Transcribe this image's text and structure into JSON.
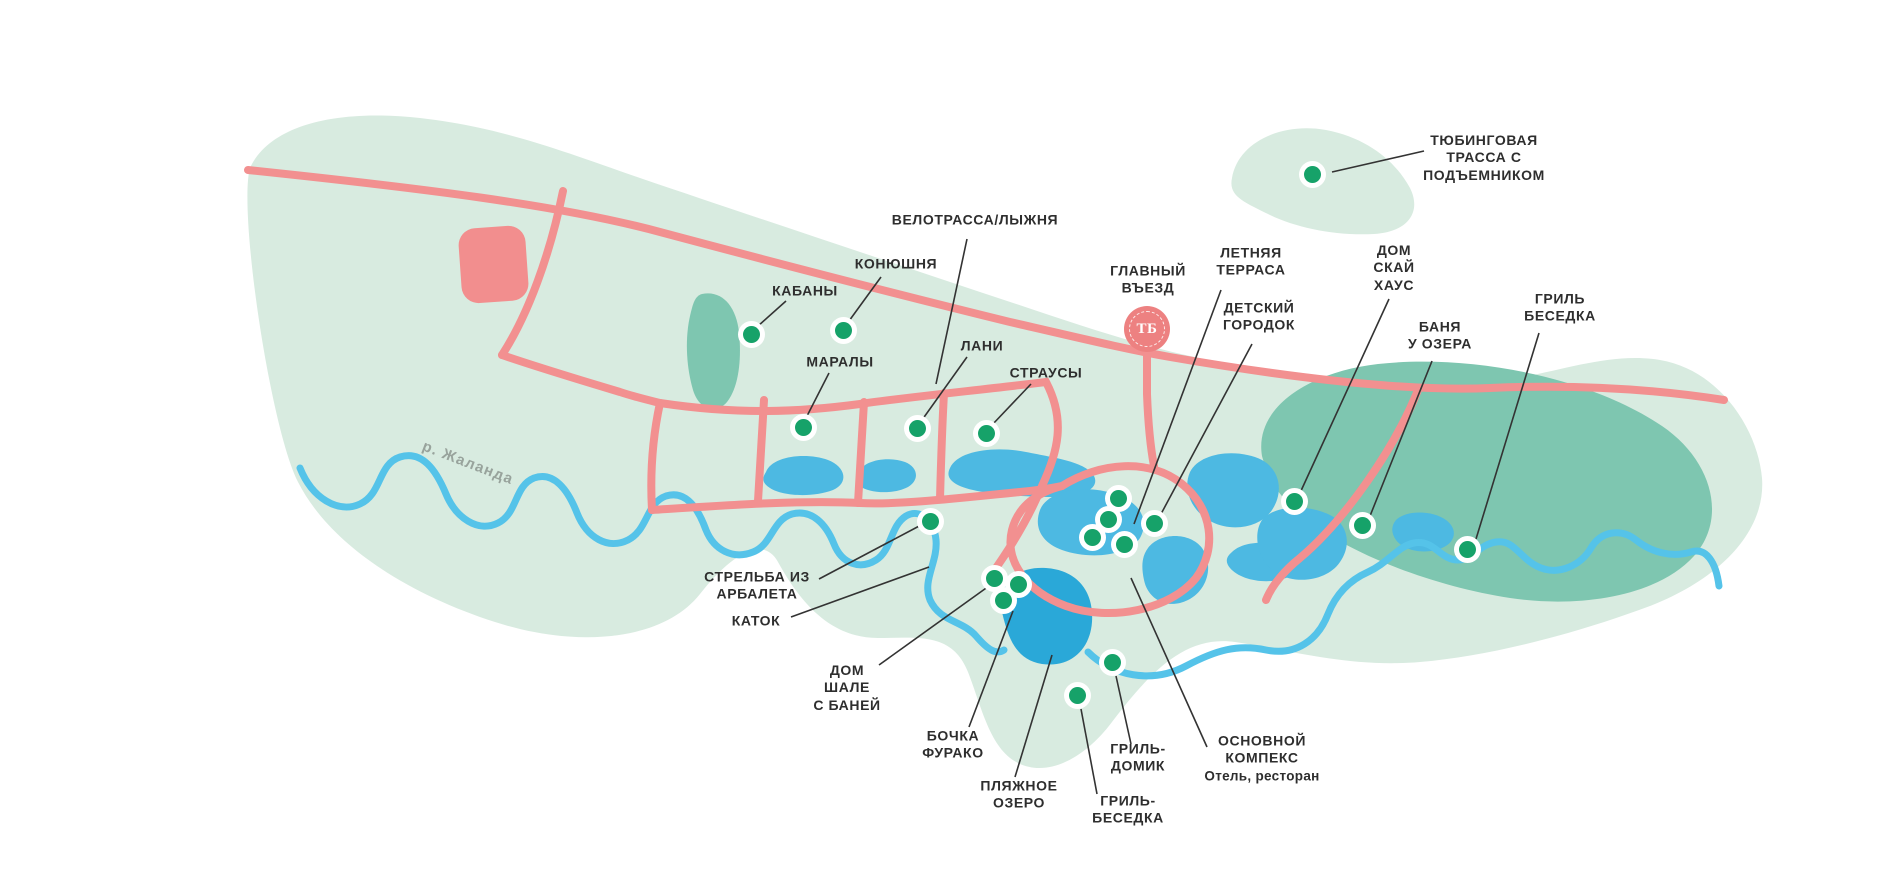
{
  "map": {
    "river_label": "р. Жаланда",
    "entrance": {
      "label": "ГЛАВНЫЙ\nВЪЕЗД",
      "monogram": "ТБ"
    },
    "pois": {
      "tubing": "ТЮБИНГОВАЯ\nТРАССА С\nПОДЪЕМНИКОМ",
      "bike_ski": "ВЕЛОТРАССА/ЛЫЖНЯ",
      "stables": "КОНЮШНЯ",
      "boars": "КАБАНЫ",
      "deer": "МАРАЛЫ",
      "fallow_deer": "ЛАНИ",
      "ostriches": "СТРАУСЫ",
      "summer_terrace": "ЛЕТНЯЯ\nТЕРРАСА",
      "kids_playground": "ДЕТСКИЙ\nГОРОДОК",
      "sky_house": "ДОМ\nСКАЙ\nХАУС",
      "lake_banya": "БАНЯ\nУ ОЗЕРА",
      "grill_gazebo_east": "ГРИЛЬ\nБЕСЕДКА",
      "crossbow": "СТРЕЛЬБА ИЗ\nАРБАЛЕТА",
      "ice_rink": "КАТОК",
      "chalet": "ДОМ\nШАЛЕ\nС БАНЕЙ",
      "furaco": "БОЧКА\nФУРАКО",
      "beach_lake": "ПЛЯЖНОЕ\nОЗЕРО",
      "grill_house": "ГРИЛЬ-\nДОМИК",
      "grill_gazebo_south": "ГРИЛЬ-\nБЕСЕДКА",
      "main_complex_title": "ОСНОВНОЙ\nКОМПЕКС",
      "main_complex_subtitle": "Отель, ресторан"
    },
    "colors": {
      "map_area": "#d8ebe0",
      "forest": "#7ec6b0",
      "lake": "#4db9e2",
      "beach_lake": "#2aa8d8",
      "river": "#55c3e9",
      "road": "#f29090",
      "marker": "#16a269",
      "entrance_badge": "#ed8181",
      "label_text": "#2e2e2e",
      "river_label_text": "#98a39c"
    }
  }
}
